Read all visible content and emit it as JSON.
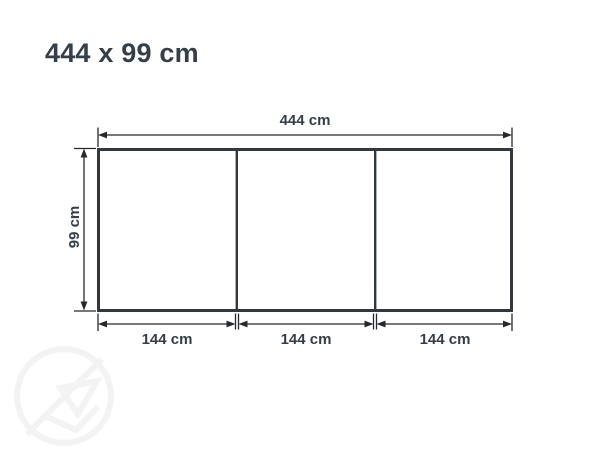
{
  "page": {
    "title": "444 x 99 cm"
  },
  "diagram": {
    "type": "dimension-drawing",
    "overall": {
      "width_cm": 444,
      "height_cm": 99,
      "width_label": "444 cm",
      "height_label": "99 cm"
    },
    "sections": [
      {
        "width_cm": 144,
        "width_label": "144 cm"
      },
      {
        "width_cm": 144,
        "width_label": "144 cm"
      },
      {
        "width_cm": 144,
        "width_label": "144 cm"
      }
    ],
    "section_count": 3
  },
  "icons": {
    "watermark": "circular-logo-watermark"
  },
  "colors": {
    "background": "#ffffff",
    "text": "#333e48",
    "dimension_line": "#26282b",
    "outline": "#32383e",
    "watermark": "#f4f4f4"
  }
}
